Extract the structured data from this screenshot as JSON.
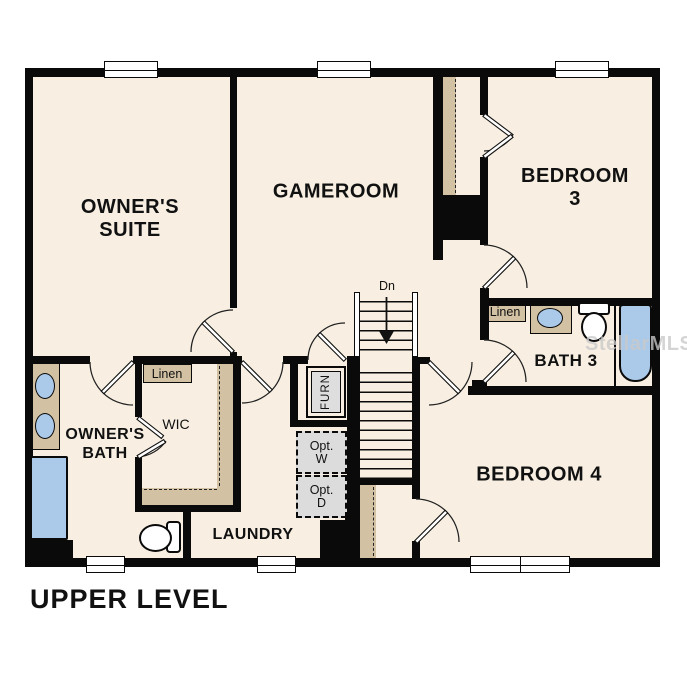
{
  "title": "UPPER LEVEL",
  "watermark": "StellarMLS",
  "labels": {
    "owners_suite": "OWNER'S\nSUITE",
    "gameroom": "GAMEROOM",
    "bedroom3": "BEDROOM 3",
    "bedroom4": "BEDROOM 4",
    "bath3": "BATH 3",
    "owners_bath": "OWNER'S\nBATH",
    "wic": "WIC",
    "laundry": "LAUNDRY",
    "linen_owner": "Linen",
    "linen_bath3": "Linen",
    "stairs_down": "Dn",
    "furnace": "FURN",
    "opt_washer": "Opt.\nW",
    "opt_dryer": "Opt.\nD"
  },
  "colors": {
    "floor": "#f8efe2",
    "wall": "#0a0a0a",
    "tan": "#d2c2a3",
    "blue": "#abc9e9",
    "gray": "#dcdcdc"
  }
}
